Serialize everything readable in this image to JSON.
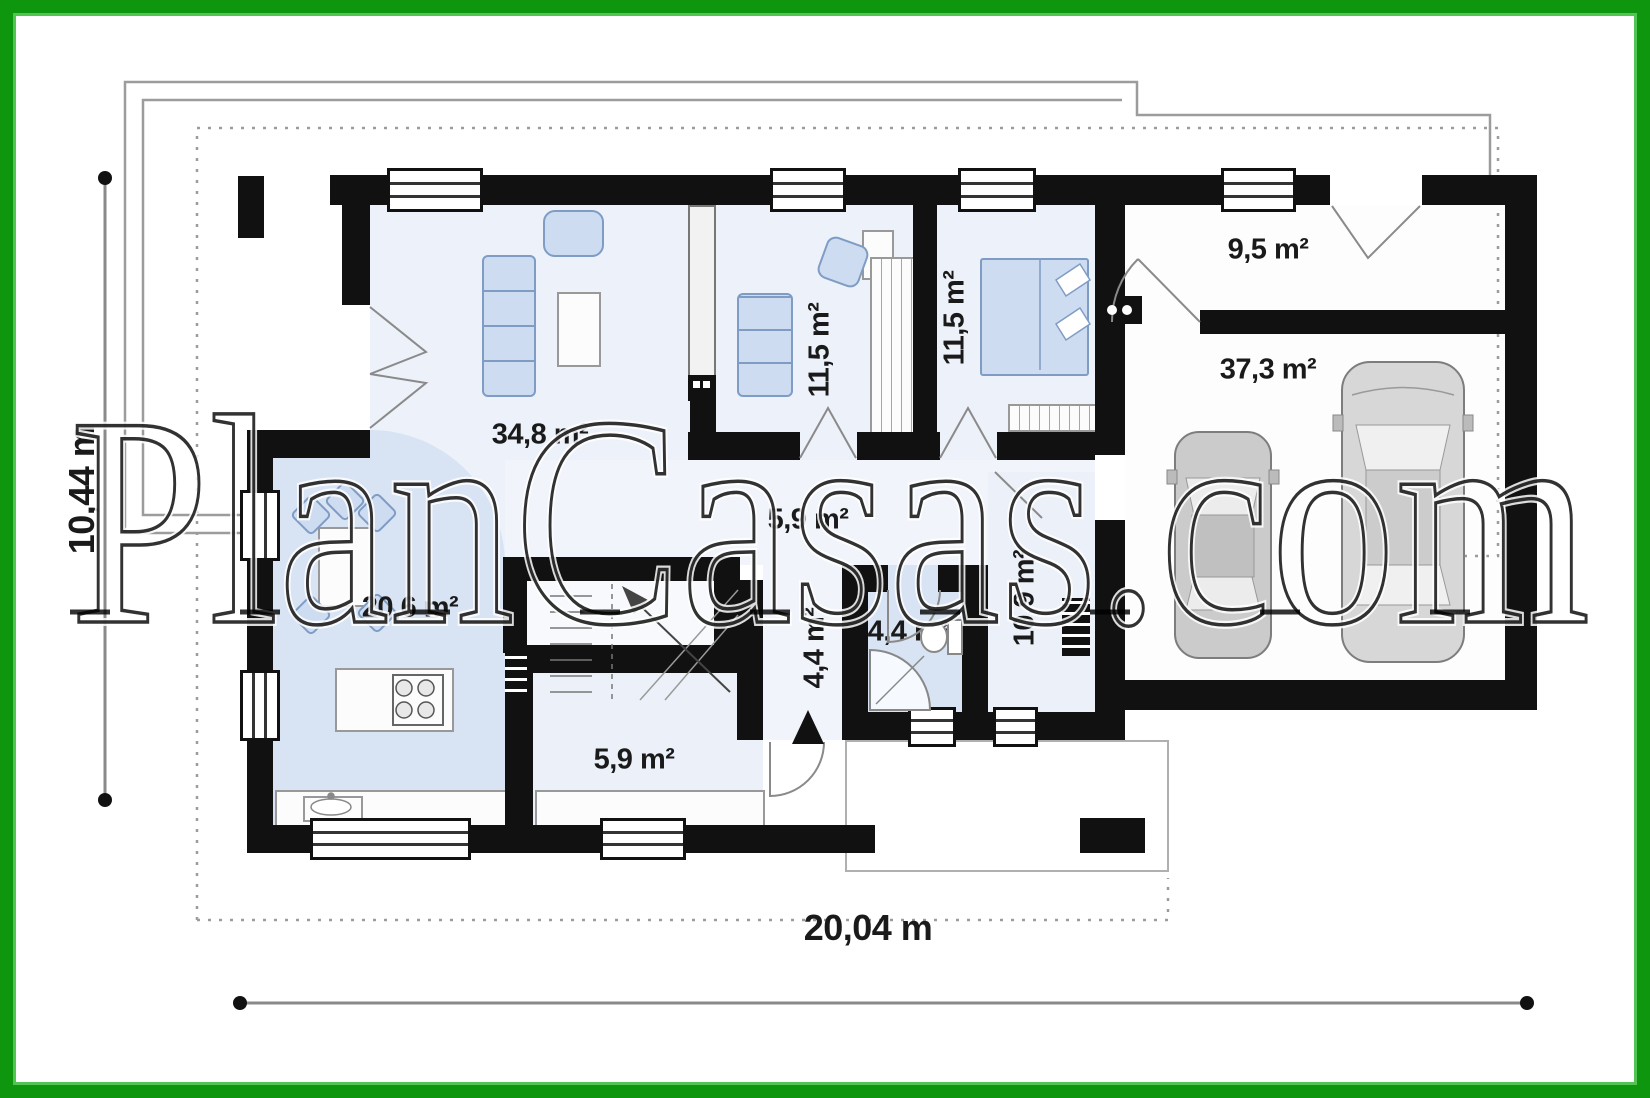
{
  "watermark": {
    "text": "PlanCasas.com"
  },
  "dimensions": {
    "width_label": "20,04 m",
    "height_label": "10,44 m"
  },
  "rooms": [
    {
      "name": "living-room",
      "area_label": "34,8 m²"
    },
    {
      "name": "study",
      "area_label": "11,5 m²"
    },
    {
      "name": "bedroom",
      "area_label": "11,5 m²"
    },
    {
      "name": "vestibule",
      "area_label": "9,5 m²"
    },
    {
      "name": "garage",
      "area_label": "37,3 m²"
    },
    {
      "name": "kitchen-dining",
      "area_label": "20,6 m²"
    },
    {
      "name": "hallway",
      "area_label": "5,9 m²"
    },
    {
      "name": "entry-hall",
      "area_label": "4,4 m²"
    },
    {
      "name": "bathroom",
      "area_label": "4,4 m²"
    },
    {
      "name": "utility-room",
      "area_label": "10,9 m²"
    },
    {
      "name": "storage",
      "area_label": "5,9 m²"
    }
  ],
  "colors": {
    "frame_green": "#0e970e",
    "wall_black": "#111111",
    "floor_blue": "#d8e3f3",
    "furniture_blue": "#cddcf0"
  }
}
